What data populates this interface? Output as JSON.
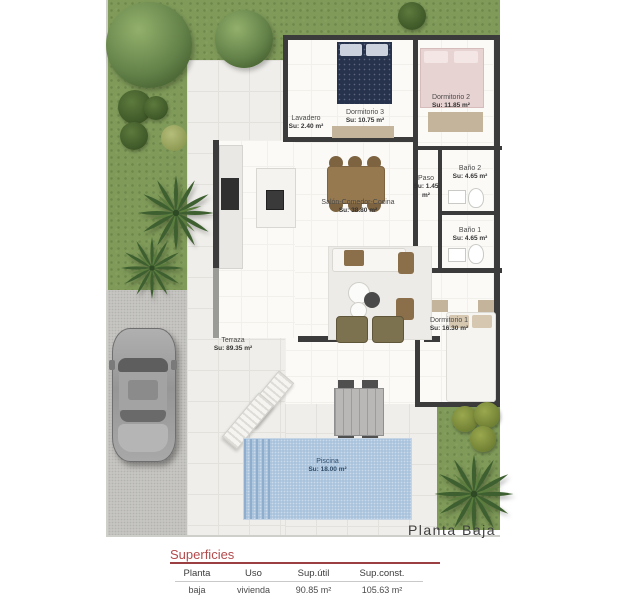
{
  "plan": {
    "caption": "Planta Baja",
    "rooms": {
      "lavadero": {
        "name": "Lavadero",
        "area": "Su: 2.40 m²"
      },
      "dormitorio3": {
        "name": "Dormitorio 3",
        "area": "Su: 10.75 m²"
      },
      "dormitorio2": {
        "name": "Dormitorio 2",
        "area": "Su: 11.85 m²"
      },
      "paso": {
        "name": "Paso",
        "area": "Su: 1.45 m²"
      },
      "bano2": {
        "name": "Baño 2",
        "area": "Su: 4.65 m²"
      },
      "bano1": {
        "name": "Baño 1",
        "area": "Su: 4.65 m²"
      },
      "salon": {
        "name": "Salón-Comedor-Cocina",
        "area": "Su: 38.80 m²"
      },
      "dormitorio1": {
        "name": "Dormitorio 1",
        "area": "Su: 16.30 m²"
      },
      "terraza": {
        "name": "Terraza",
        "area": "Su: 89.35 m²"
      },
      "piscina": {
        "name": "Piscina",
        "area": "Su: 18.00 m²"
      }
    }
  },
  "surfaces_table": {
    "title": "Superficies",
    "headers": [
      "Planta",
      "Uso",
      "Sup.útil",
      "Sup.const."
    ],
    "rows": [
      {
        "planta": "baja",
        "uso": "vivienda",
        "sup_util": "90.85 m²",
        "sup_const": "105.63 m²"
      }
    ]
  },
  "colors": {
    "accent_red": "#b34a4c",
    "grass_green": "#7f9a59",
    "pool_blue": "#a9c3dd",
    "wall_dark": "#3b3b3b",
    "terrace_tile": "#efeeea",
    "driveway_grey": "#c7c6c2"
  }
}
